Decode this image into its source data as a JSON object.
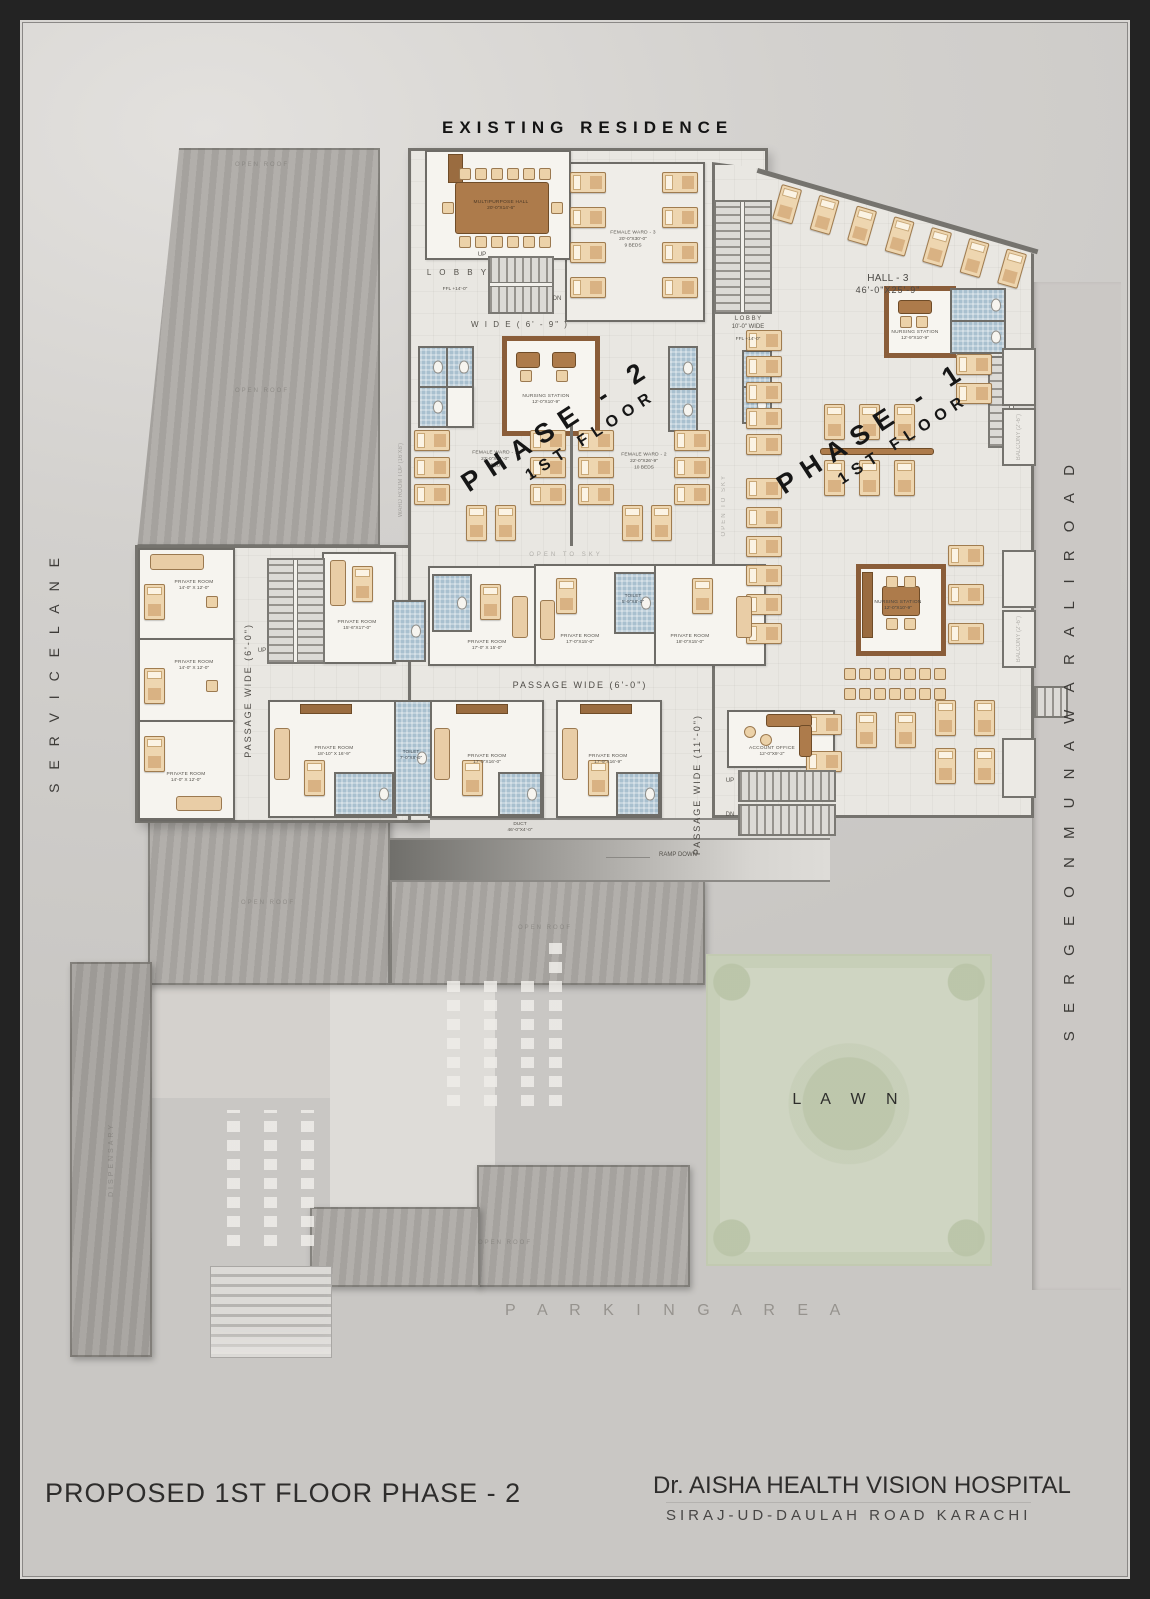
{
  "surround": {
    "existing_residence": "EXISTING RESIDENCE",
    "service_lane": "S E R V I C E   L A N E",
    "road_right": "S E R G E O N   M U N A W A R   A L I   R O A D",
    "parking": "P A R K I N G    A R E A",
    "lawn": "L A W N"
  },
  "phase2": {
    "name": "PHASE - 2",
    "floor": "1ST FLOOR"
  },
  "phase1": {
    "name": "PHASE - 1",
    "floor": "1ST FLOOR"
  },
  "titleblock": {
    "left": "PROPOSED  1ST  FLOOR  PHASE - 2",
    "name": "Dr. AISHA HEALTH VISION HOSPITAL",
    "address": "SIRAJ-UD-DAULAH   ROAD  KARACHI"
  },
  "halls": {
    "multipurpose": {
      "n": "MULTIPURPOSE HALL",
      "d": "20'-0\"X14'-6\""
    },
    "hall3": {
      "n": "HALL - 3",
      "d": "46'-0\"X25'-9\""
    }
  },
  "wards": {
    "fw1": {
      "n": "FEMALE WARD - 1",
      "d": "22'-0\"X31'-0\"",
      "b": "9 BEDS"
    },
    "fw2": {
      "n": "FEMALE WARD - 2",
      "d": "22'-0\"X26'-9\"",
      "b": "10 BEDS"
    },
    "fw3": {
      "n": "FEMALE WARD - 3",
      "d": "20'-0\"X30'-0\"",
      "b": "9 BEDS"
    }
  },
  "nursing": {
    "p2": {
      "n": "NURSING STATION",
      "d": "12'-0\"X10'-9\""
    },
    "h3": {
      "n": "NURSING STATION",
      "d": "12'-9\"X10'-9\""
    },
    "p1": {
      "n": "NURSING STATION",
      "d": "12'-0\"X10'-9\""
    }
  },
  "private": [
    {
      "n": "PRIVATE ROOM",
      "d": "14'-0\" X 12'-0\""
    },
    {
      "n": "PRIVATE ROOM",
      "d": "14'-0\" X 12'-0\""
    },
    {
      "n": "PRIVATE ROOM",
      "d": "14'-0\" X 12'-0\""
    },
    {
      "n": "PRIVATE ROOM",
      "d": "15'-6\"X17'-0\""
    },
    {
      "n": "PRIVATE ROOM",
      "d": "17'-0\" X 15'-0\""
    },
    {
      "n": "PRIVATE ROOM",
      "d": "17'-0\"X15'-0\""
    },
    {
      "n": "PRIVATE ROOM",
      "d": "18'-0\"X15'-0\""
    },
    {
      "n": "PRIVATE ROOM",
      "d": "18'-10\" X 16'-9\""
    },
    {
      "n": "PRIVATE ROOM",
      "d": "17'-0\"X16'-0\""
    },
    {
      "n": "PRIVATE ROOM",
      "d": "17'-9\"X16'-9\""
    }
  ],
  "toilets": {
    "t1": {
      "n": "TOILET",
      "d": "5'-9\"X8'-0\""
    },
    "t2": {
      "n": "TOILET",
      "d": "7'-0\"X8'-0\""
    },
    "small": "TOILET"
  },
  "office": {
    "n": "ACCOUNT OFFICE",
    "d": "12'-0\"X9'-2\""
  },
  "duct": {
    "n": "DUCT",
    "d": "46'-0\"X4'-0\""
  },
  "lobby": {
    "left": "L O B B Y",
    "left_lvl": "FFL +14'-0\"",
    "mid1": "L O B B Y",
    "mid2": "10'-0\" WIDE",
    "mid_lvl": "FFL +14'-0\"",
    "wide69": "W I D E   ( 6' - 9\" )"
  },
  "passages": {
    "v6": "PASSAGE WIDE (6'-0\")",
    "h6": "PASSAGE WIDE (6'-0\")",
    "v11": "PASSAGE WIDE (11'-0\")"
  },
  "notes": {
    "ramp": "RAMP DOWN",
    "open_sky": "OPEN TO SKY",
    "open_roof": "OPEN ROOF",
    "dispensary": "DISPENSARY",
    "wardtop": "WARD ROOM TOP (16'X8')",
    "balcony": "BALCONY (2'-6\")",
    "up": "UP",
    "dn": "DN"
  }
}
